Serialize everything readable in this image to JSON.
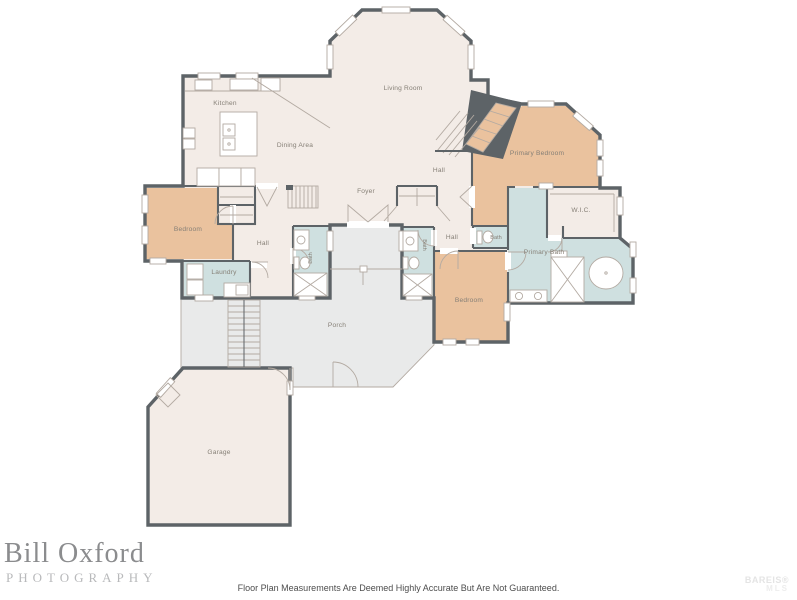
{
  "colors": {
    "wall": "#5d6367",
    "cream": "#f3ece7",
    "tan": "#eac29e",
    "blue": "#cfe0e0",
    "porch": "#e9eaea",
    "line": "#b3aaa2",
    "label": "#857f76"
  },
  "plan": {
    "rooms": {
      "kitchen": "Kitchen",
      "living_room": "Living Room",
      "dining_area": "Dining Area",
      "hall_a": "Hall",
      "hall_b": "Hall",
      "hall_c": "Hall",
      "foyer": "Foyer",
      "primary_bedroom": "Primary Bedroom",
      "wic": "W.I.C.",
      "bath_hall": "Bath",
      "bath_left": "Bath",
      "bath_right": "Bath",
      "primary_bath": "Primary Bath",
      "bedroom_left": "Bedroom",
      "bedroom_right": "Bedroom",
      "laundry": "Laundry",
      "porch": "Porch",
      "garage": "Garage"
    }
  },
  "footer": {
    "brand_name": "Bill Oxford",
    "brand_sub": "PHOTOGRAPHY",
    "disclaimer": "Floor Plan Measurements Are Deemed Highly Accurate But Are Not Guaranteed.",
    "mls_line1": "BAREIS®",
    "mls_line2": "MLS"
  }
}
